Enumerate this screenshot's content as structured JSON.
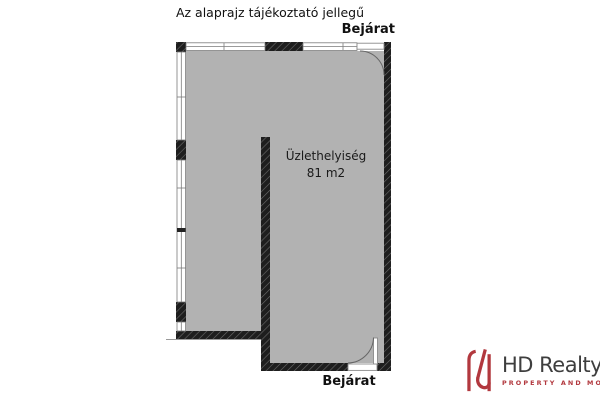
{
  "title": "Az alaprajz tájékoztató jellegű",
  "plan": {
    "entrance_top_label": "Bejárat",
    "entrance_bottom_label": "Bejárat",
    "room_name": "Üzlethelyiség",
    "room_area": "81 m2"
  },
  "branding": {
    "logo_text": "HD Realty",
    "tagline": "PROPERTY AND MORE",
    "logo_mark": "hd-monogram"
  },
  "colors": {
    "floor_fill": "#b2b2b2",
    "wall": "#1e1e1e",
    "accent_red": "#b2383e",
    "logo_text_color": "#3e3e3e",
    "text": "#111111"
  }
}
